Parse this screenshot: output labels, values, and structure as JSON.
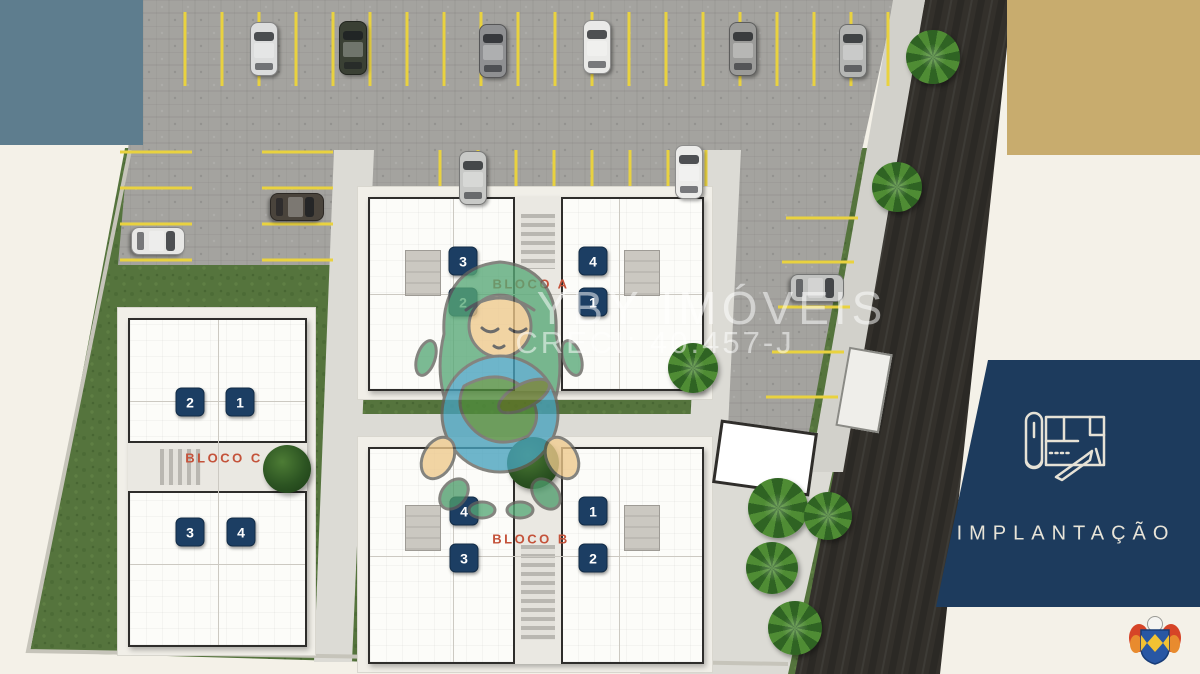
{
  "panel": {
    "title": "IMPLANTAÇÃO",
    "icon": "blueprint-icon"
  },
  "watermark": {
    "brand": "YBY IMÓVEIS",
    "creci": "CRECI: 40.457-J"
  },
  "colors": {
    "cream": "#f4f1e8",
    "bluegray": "#5e7d8e",
    "tan": "#c8ac6e",
    "navy": "#1d3b5d",
    "orange": "#c4523a",
    "badge": "#1c3e63",
    "stall_yellow": "#e9d23f"
  },
  "blocks": [
    {
      "id": "bloco-a",
      "label": "BLOCO A",
      "x": 368,
      "y": 197,
      "w": 332,
      "h": 190,
      "orient": "h",
      "stair": [
        0.09,
        0.37
      ],
      "shaft_pos": 0.5,
      "label_x": 531,
      "label_y": 284,
      "units": [
        {
          "n": "3",
          "x": 463,
          "y": 261
        },
        {
          "n": "4",
          "x": 593,
          "y": 261
        },
        {
          "n": "2",
          "x": 463,
          "y": 302
        },
        {
          "n": "1",
          "x": 593,
          "y": 302
        }
      ]
    },
    {
      "id": "bloco-b",
      "label": "BLOCO B",
      "x": 368,
      "y": 447,
      "w": 332,
      "h": 213,
      "orient": "h",
      "stair": [
        0.45,
        0.89
      ],
      "shaft_pos": 0.5,
      "label_x": 531,
      "label_y": 539,
      "units": [
        {
          "n": "4",
          "x": 464,
          "y": 511
        },
        {
          "n": "1",
          "x": 593,
          "y": 511
        },
        {
          "n": "3",
          "x": 464,
          "y": 558
        },
        {
          "n": "2",
          "x": 593,
          "y": 558
        }
      ]
    },
    {
      "id": "bloco-c",
      "label": "BLOCO C",
      "x": 128,
      "y": 318,
      "w": 175,
      "h": 325,
      "orient": "v",
      "stair": [
        0.18,
        0.41
      ],
      "shaft_pos": 0.445,
      "label_x": 224,
      "label_y": 458,
      "units": [
        {
          "n": "2",
          "x": 190,
          "y": 402
        },
        {
          "n": "1",
          "x": 240,
          "y": 402
        },
        {
          "n": "3",
          "x": 190,
          "y": 532
        },
        {
          "n": "4",
          "x": 241,
          "y": 532
        }
      ]
    }
  ],
  "site": {
    "ground": [
      {
        "name": "lawn-main",
        "texture": "lawn",
        "points": "125,148 888,148 846,372 788,674 30,652"
      },
      {
        "name": "lawn-sliver",
        "texture": "lawn",
        "points": "128,183 137,183 123,265 112,265"
      },
      {
        "name": "sidewalk-bottom-right",
        "texture": "walk",
        "points": "660,470 833,470 790,674 640,674"
      },
      {
        "name": "green-road-strip",
        "texture": "lawn",
        "points": "833,470 848,470 803,674 788,674"
      },
      {
        "name": "parking-top",
        "texture": "pave",
        "points": "143,0 895,0 862,150 128,150"
      },
      {
        "name": "parking-left",
        "texture": "pave",
        "points": "128,150 345,150 345,265 118,265"
      },
      {
        "name": "parking-center",
        "texture": "pave",
        "points": "345,150 730,150 730,200 345,200"
      },
      {
        "name": "parking-right",
        "texture": "pave",
        "points": "730,148 862,148 800,480 725,480"
      },
      {
        "name": "walkway-vertical",
        "texture": "walk",
        "points": "334,150 374,150 352,662 314,662"
      },
      {
        "name": "walkway-horizontal",
        "texture": "walk",
        "points": "348,414 705,414 705,440 347,440"
      },
      {
        "name": "walkway-right",
        "texture": "walk",
        "points": "703,150 741,150 726,472 688,472"
      },
      {
        "name": "road",
        "texture": "road",
        "points": "925,0 1012,0 940,674 795,674"
      },
      {
        "name": "sidewalk-road",
        "texture": "side",
        "points": "893,0 925,0 843,472 810,472"
      }
    ],
    "stall_groups": [
      {
        "dir": "v",
        "y1": 12,
        "y2": 86,
        "xs": [
          185,
          222,
          259,
          296,
          333,
          370,
          407,
          444,
          481,
          518,
          555,
          592,
          629,
          666,
          703,
          740,
          777,
          814,
          851,
          888
        ]
      },
      {
        "dir": "v",
        "y1": 150,
        "y2": 196,
        "xs": [
          440,
          478,
          516,
          554,
          592,
          630,
          668,
          706
        ]
      },
      {
        "dir": "h",
        "x1": 120,
        "x2": 192,
        "ys": [
          152,
          188,
          224,
          260
        ]
      },
      {
        "dir": "h",
        "x1": 262,
        "x2": 333,
        "ys": [
          152,
          188,
          224,
          260
        ]
      },
      {
        "dir": "h",
        "pairs": [
          [
            786,
            218
          ],
          [
            782,
            262
          ],
          [
            778,
            307
          ],
          [
            772,
            352
          ],
          [
            766,
            397
          ]
        ],
        "len": 72
      }
    ],
    "bushes": [
      [
        398,
        280
      ],
      [
        444,
        280
      ],
      [
        620,
        280
      ],
      [
        666,
        280
      ],
      [
        398,
        537
      ],
      [
        444,
        537
      ],
      [
        620,
        537
      ],
      [
        666,
        537
      ],
      [
        205,
        335
      ],
      [
        223,
        335
      ],
      [
        205,
        380
      ],
      [
        223,
        380
      ],
      [
        208,
        556
      ],
      [
        224,
        556
      ],
      [
        208,
        602
      ],
      [
        224,
        602
      ]
    ],
    "patios": [
      {
        "x": 405,
        "y": 250,
        "w": 34,
        "h": 44
      },
      {
        "x": 624,
        "y": 250,
        "w": 34,
        "h": 44
      },
      {
        "x": 405,
        "y": 505,
        "w": 34,
        "h": 44
      },
      {
        "x": 624,
        "y": 505,
        "w": 34,
        "h": 44
      }
    ],
    "structures": [
      {
        "x": 716,
        "y": 426,
        "w": 92,
        "h": 58,
        "rot": 8,
        "style": "gate"
      },
      {
        "x": 842,
        "y": 350,
        "w": 40,
        "h": 76,
        "rot": 10,
        "style": "shed"
      }
    ]
  },
  "cars": [
    {
      "x": 263,
      "y": 48,
      "dir": "v",
      "color": "#dcdddd"
    },
    {
      "x": 352,
      "y": 47,
      "dir": "v",
      "color": "#3a4034"
    },
    {
      "x": 492,
      "y": 50,
      "dir": "v",
      "color": "#8f9092"
    },
    {
      "x": 596,
      "y": 46,
      "dir": "v",
      "color": "#eaeae8"
    },
    {
      "x": 742,
      "y": 48,
      "dir": "v",
      "color": "#9b9b99"
    },
    {
      "x": 852,
      "y": 50,
      "dir": "v",
      "color": "#b5b6b4"
    },
    {
      "x": 472,
      "y": 177,
      "dir": "v",
      "color": "#c8c9c7"
    },
    {
      "x": 688,
      "y": 171,
      "dir": "v",
      "color": "#ececea"
    },
    {
      "x": 296,
      "y": 206,
      "dir": "h",
      "color": "#4a443c"
    },
    {
      "x": 157,
      "y": 240,
      "dir": "h",
      "color": "#e7e7e5"
    },
    {
      "x": 816,
      "y": 287,
      "dir": "h",
      "color": "#c2c3c1"
    }
  ],
  "trees": {
    "palms": [
      {
        "x": 933,
        "y": 57,
        "r": 27
      },
      {
        "x": 897,
        "y": 187,
        "r": 25
      },
      {
        "x": 693,
        "y": 368,
        "r": 25
      },
      {
        "x": 778,
        "y": 508,
        "r": 30
      },
      {
        "x": 828,
        "y": 516,
        "r": 24
      },
      {
        "x": 772,
        "y": 568,
        "r": 26
      },
      {
        "x": 795,
        "y": 628,
        "r": 27
      }
    ],
    "round": [
      {
        "x": 533,
        "y": 463,
        "r": 26
      },
      {
        "x": 287,
        "y": 469,
        "r": 24
      }
    ]
  }
}
